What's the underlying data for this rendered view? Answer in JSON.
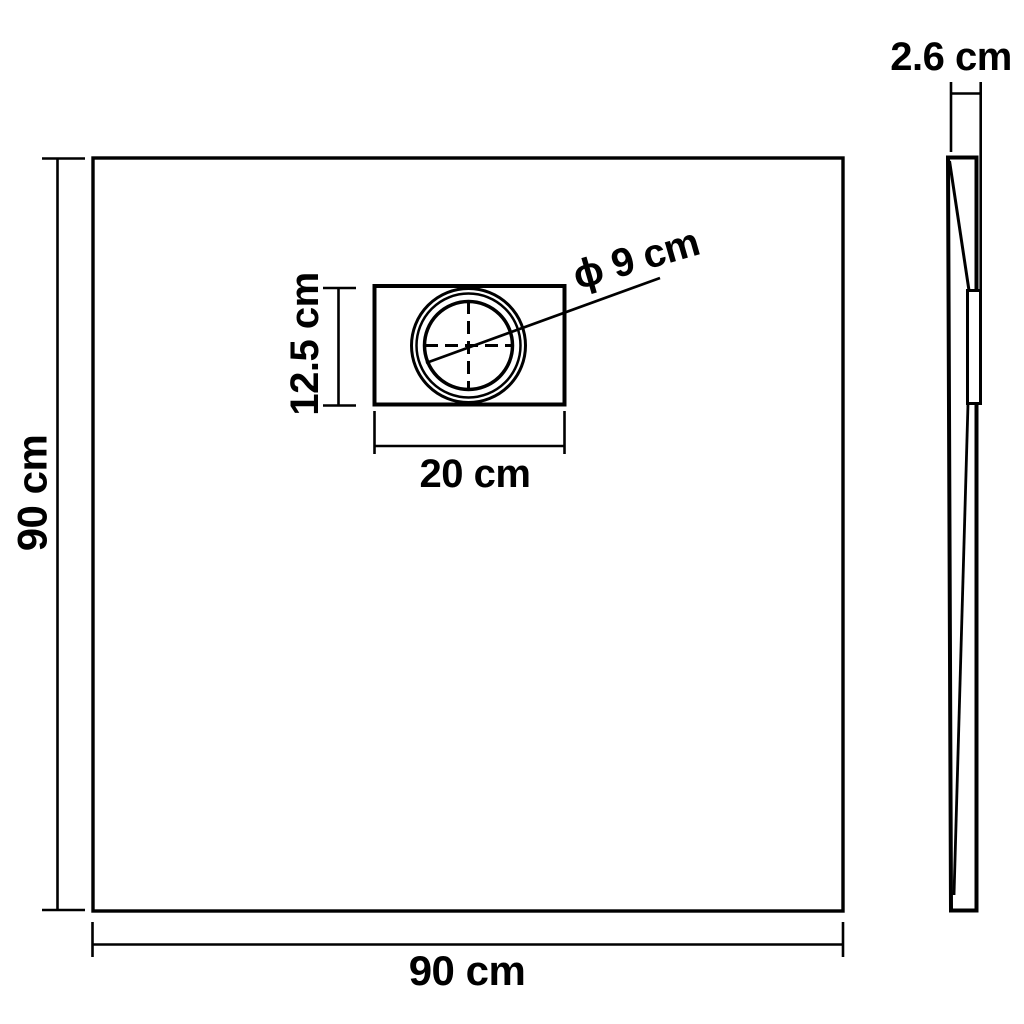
{
  "diagram": {
    "background": "#ffffff",
    "line_color": "#000000",
    "top_view": {
      "width_label": "90 cm",
      "height_label": "90 cm",
      "drain": {
        "width_label": "20 cm",
        "height_label": "12.5 cm",
        "diameter_label": "ϕ 9 cm"
      }
    },
    "side_view": {
      "thickness_label": "2.6 cm"
    }
  }
}
